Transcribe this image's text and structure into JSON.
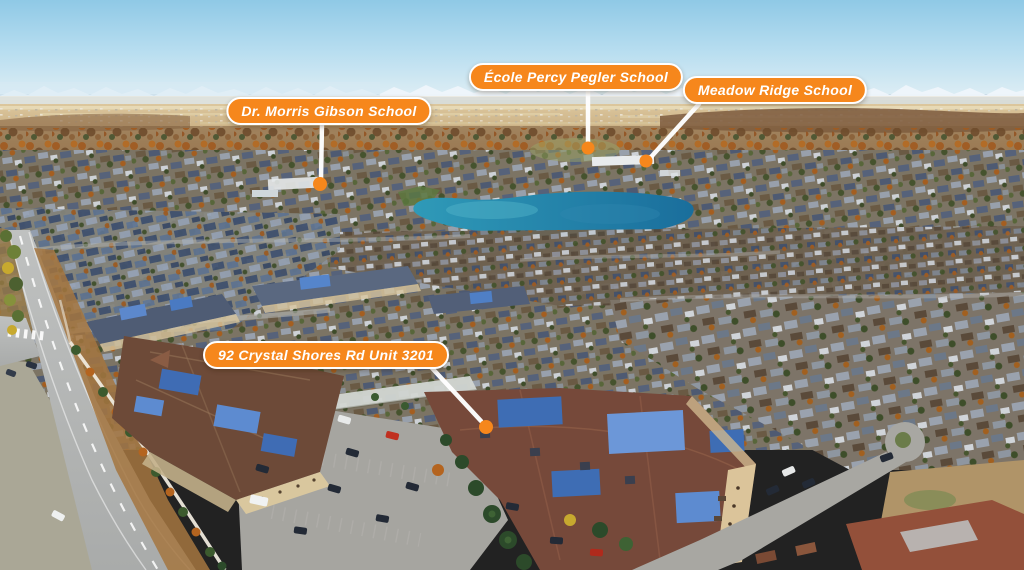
{
  "view": {
    "type": "annotated-aerial-photograph",
    "description": "Drone aerial view of lakeside suburban community with school and property callouts",
    "width_px": 1024,
    "height_px": 570
  },
  "annotations": [
    {
      "id": "dr-morris-gibson-school",
      "kind": "school",
      "text": "Dr. Morris Gibson School"
    },
    {
      "id": "ecole-percy-pegler-school",
      "kind": "school",
      "text": "École Percy Pegler School"
    },
    {
      "id": "meadow-ridge-school",
      "kind": "school",
      "text": "Meadow Ridge School"
    },
    {
      "id": "subject-property",
      "kind": "property",
      "text": "92 Crystal Shores Rd Unit 3201"
    }
  ],
  "colors": {
    "label_background": "#F6871C",
    "label_border": "#FFFFFF",
    "label_text": "#FFFFFF",
    "pointer_line": "#FFFFFF",
    "marker_dot": "#F6871C",
    "sky": "#A9D8EE",
    "lake": "#2383AC"
  }
}
